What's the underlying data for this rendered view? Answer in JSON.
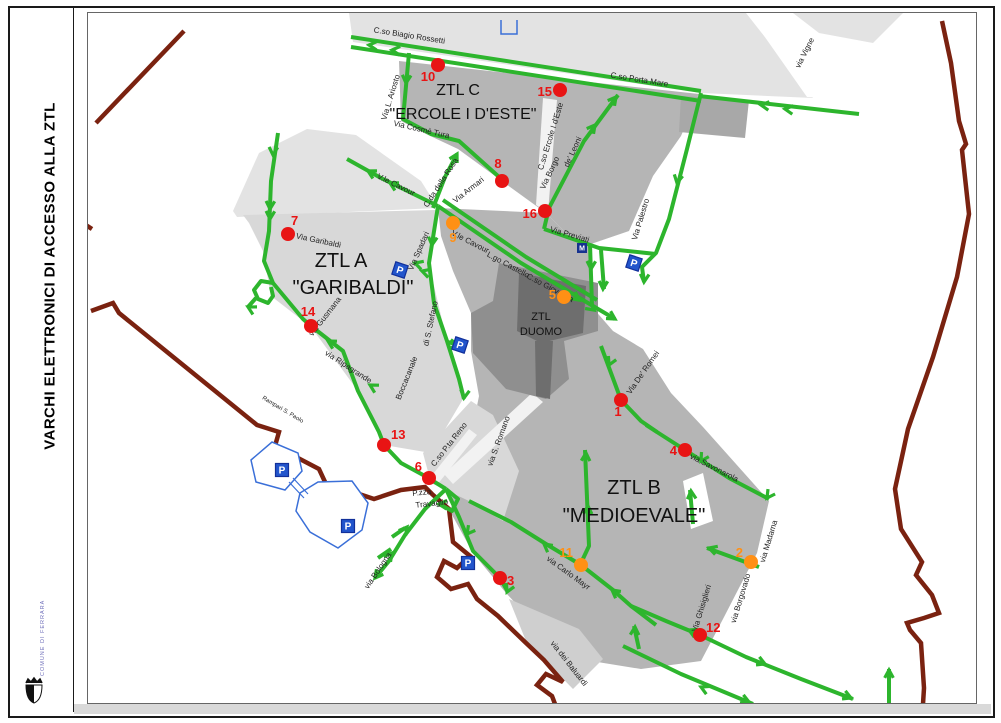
{
  "page": {
    "sidebar_title": "VARCHI ELETTRONICI DI ACCESSO ALLA ZTL",
    "logo_text": "COMUNE DI FERRARA"
  },
  "map": {
    "zones": [
      {
        "line1": "ZTL A",
        "line2": "\"GARIBALDI\""
      },
      {
        "line1": "ZTL B",
        "line2": "\"MEDIOEVALE\""
      },
      {
        "line1": "ZTL C",
        "line2": "\"ERCOLE I D'ESTE\""
      },
      {
        "line1": "ZTL",
        "line2": "DUOMO"
      }
    ],
    "gates": [
      {
        "number": "1",
        "color": "red"
      },
      {
        "number": "2",
        "color": "orange"
      },
      {
        "number": "3",
        "color": "red"
      },
      {
        "number": "4",
        "color": "red"
      },
      {
        "number": "5",
        "color": "orange"
      },
      {
        "number": "6",
        "color": "red"
      },
      {
        "number": "7",
        "color": "red"
      },
      {
        "number": "8",
        "color": "red"
      },
      {
        "number": "9",
        "color": "orange"
      },
      {
        "number": "10",
        "color": "red"
      },
      {
        "number": "11",
        "color": "orange"
      },
      {
        "number": "12",
        "color": "red"
      },
      {
        "number": "13",
        "color": "red"
      },
      {
        "number": "14",
        "color": "red"
      },
      {
        "number": "15",
        "color": "red"
      },
      {
        "number": "16",
        "color": "red"
      }
    ],
    "streets": [
      "C.so Biagio Rossetti",
      "C.so Porta Mare",
      "via Vigne",
      "Via L. Ariosto",
      "Via Cosmè Tura",
      "C.da della Rosa",
      "V.le Cavour",
      "Via Armari",
      "C.so Ercole I d'Este",
      "Via Borgo",
      "de' Leoni",
      "Via Palestro",
      "Via Previati",
      "V.le Cavour",
      "L.go Castello",
      "C.so Giovecca",
      "Via Spadari",
      "di S. Stefano",
      "Boccacanale",
      "Via Garibaldi",
      "via Gusmana",
      "via Ripagrande",
      "Rampari S. Paolo",
      "via S. Romano",
      "C.so P.ta Reno",
      "P.zza",
      "Travaglio",
      "via Bologna",
      "via Carlo Mayr",
      "via dei Baluardi",
      "Via Ghisiglieri",
      "via Borgovado",
      "via Savonarola",
      "via Madama",
      "Via De' Romei"
    ],
    "parking_label": "P",
    "transit_label": "M"
  },
  "colors": {
    "road_green": "#2db52d",
    "wall_maroon": "#7a2210",
    "gate_red": "#e81414",
    "gate_orange": "#ff9015",
    "parking_blue": "#2255cc",
    "parking_dark": "#12309a",
    "zone_light": "#e3e3e3",
    "zone_a": "#d8d8d8",
    "zone_bc": "#b5b5b5",
    "zone_mid": "#a8a8a8",
    "zone_mid2": "#cfcfcf",
    "zone_duomo": "#8f8f8f",
    "zone_cath": "#6e6e6e",
    "corridor": "#f2f2f2",
    "label_dark": "#222222"
  }
}
